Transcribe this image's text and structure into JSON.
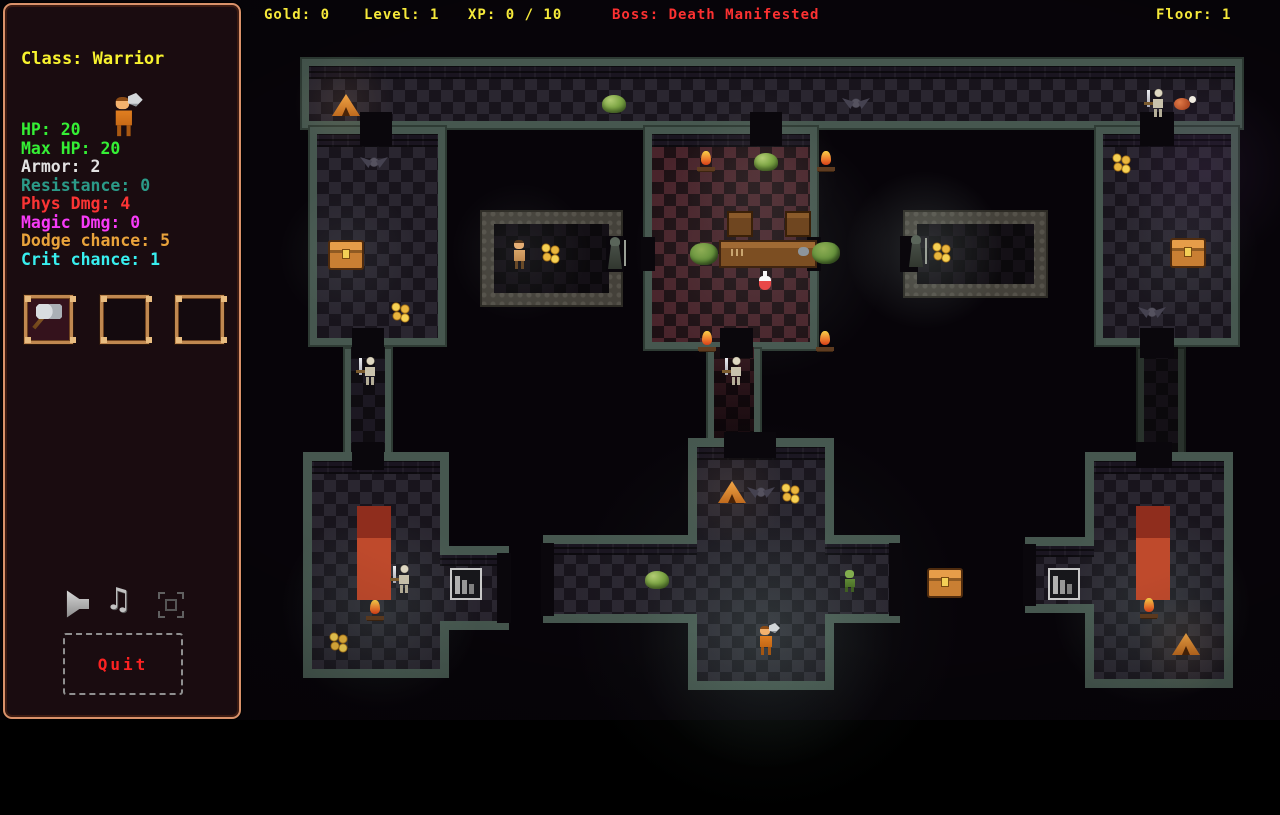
{
  "topbar": {
    "gold": {
      "text": "Gold: 0",
      "color": "#f5e93a"
    },
    "level": {
      "text": "Level: 1",
      "color": "#f5e93a"
    },
    "xp": {
      "text": "XP: 0 / 10",
      "color": "#f5e93a"
    },
    "boss": {
      "text": "Boss: Death Manifested",
      "color": "#fb3131"
    },
    "floor": {
      "text": "Floor: 1",
      "color": "#f5e93a"
    }
  },
  "sidebar": {
    "class_line": {
      "text": "Class: Warrior",
      "color": "#f8f32e"
    },
    "avatar": "warrior-sprite",
    "stats": [
      {
        "text": "HP: 20",
        "color": "#35ef35"
      },
      {
        "text": "Max HP: 20",
        "color": "#35ef35"
      },
      {
        "text": "Armor: 2",
        "color": "#e2e2e2"
      },
      {
        "text": "Resistance: 0",
        "color": "#2b9a88"
      },
      {
        "text": "Phys Dmg: 4",
        "color": "#fb3434"
      },
      {
        "text": "Magic Dmg: 0",
        "color": "#f73bf7"
      },
      {
        "text": "Dodge chance: 5",
        "color": "#e9a33b"
      },
      {
        "text": "Crit chance: 1",
        "color": "#38efef"
      }
    ],
    "inventory_slots": [
      {
        "item": "axe"
      },
      {
        "item": null
      },
      {
        "item": null
      }
    ],
    "icons": [
      {
        "name": "sound-icon"
      },
      {
        "name": "music-icon",
        "glyph": "♫"
      },
      {
        "name": "fullscreen-icon"
      }
    ],
    "quit": {
      "text": "Quit",
      "color": "#fb2222"
    }
  },
  "map": {
    "wall_color": "#46574f",
    "floor_dark": "#18141c",
    "floor_red": "#1e1014",
    "sprites": [
      {
        "type": "tent",
        "x": 332,
        "y": 94
      },
      {
        "type": "slime",
        "x": 602,
        "y": 95
      },
      {
        "type": "bat",
        "x": 842,
        "y": 96
      },
      {
        "type": "skeleton",
        "x": 1146,
        "y": 88
      },
      {
        "type": "meat",
        "x": 1174,
        "y": 96
      },
      {
        "type": "bat",
        "x": 360,
        "y": 155
      },
      {
        "type": "chest",
        "x": 328,
        "y": 240
      },
      {
        "type": "coins",
        "x": 390,
        "y": 302
      },
      {
        "type": "campfire",
        "x": 697,
        "y": 151
      },
      {
        "type": "slime",
        "x": 754,
        "y": 153
      },
      {
        "type": "campfire",
        "x": 817,
        "y": 151
      },
      {
        "type": "bench",
        "x": 727,
        "y": 211
      },
      {
        "type": "bench",
        "x": 785,
        "y": 211
      },
      {
        "type": "bush",
        "x": 690,
        "y": 243
      },
      {
        "type": "table",
        "x": 719,
        "y": 240
      },
      {
        "type": "bush",
        "x": 812,
        "y": 242
      },
      {
        "type": "potion",
        "x": 759,
        "y": 271
      },
      {
        "type": "campfire",
        "x": 698,
        "y": 331
      },
      {
        "type": "campfire",
        "x": 816,
        "y": 331
      },
      {
        "type": "coins",
        "x": 1111,
        "y": 153
      },
      {
        "type": "chest",
        "x": 1170,
        "y": 238
      },
      {
        "type": "bat",
        "x": 1138,
        "y": 305
      },
      {
        "type": "villager",
        "x": 509,
        "y": 240
      },
      {
        "type": "coins",
        "x": 540,
        "y": 243
      },
      {
        "type": "reaper",
        "x": 604,
        "y": 237
      },
      {
        "type": "reaper",
        "x": 905,
        "y": 235
      },
      {
        "type": "coins",
        "x": 931,
        "y": 242
      },
      {
        "type": "skeleton",
        "x": 358,
        "y": 356
      },
      {
        "type": "skeleton",
        "x": 724,
        "y": 356
      },
      {
        "type": "carpet",
        "x": 357,
        "y": 506
      },
      {
        "type": "skeleton",
        "x": 392,
        "y": 564
      },
      {
        "type": "campfire",
        "x": 366,
        "y": 600
      },
      {
        "type": "coins",
        "x": 328,
        "y": 632
      },
      {
        "type": "shelf",
        "x": 450,
        "y": 568
      },
      {
        "type": "tent",
        "x": 718,
        "y": 481
      },
      {
        "type": "bat",
        "x": 747,
        "y": 485
      },
      {
        "type": "coins",
        "x": 780,
        "y": 483
      },
      {
        "type": "slime",
        "x": 645,
        "y": 571
      },
      {
        "type": "goblin",
        "x": 841,
        "y": 570
      },
      {
        "type": "chest",
        "x": 927,
        "y": 568
      },
      {
        "type": "player",
        "x": 755,
        "y": 626
      },
      {
        "type": "shelf",
        "x": 1048,
        "y": 568
      },
      {
        "type": "carpet",
        "x": 1136,
        "y": 506
      },
      {
        "type": "campfire",
        "x": 1140,
        "y": 598
      },
      {
        "type": "tent",
        "x": 1172,
        "y": 633
      }
    ],
    "doors": [
      {
        "x": 360,
        "y": 112,
        "w": 32,
        "h": 34
      },
      {
        "x": 750,
        "y": 112,
        "w": 32,
        "h": 34
      },
      {
        "x": 1140,
        "y": 112,
        "w": 34,
        "h": 34
      },
      {
        "x": 352,
        "y": 328,
        "w": 32,
        "h": 30
      },
      {
        "x": 720,
        "y": 328,
        "w": 33,
        "h": 30
      },
      {
        "x": 1140,
        "y": 328,
        "w": 34,
        "h": 30
      },
      {
        "x": 352,
        "y": 442,
        "w": 32,
        "h": 28
      },
      {
        "x": 724,
        "y": 432,
        "w": 52,
        "h": 26
      },
      {
        "x": 1136,
        "y": 442,
        "w": 36,
        "h": 26
      },
      {
        "x": 641,
        "y": 237,
        "w": 14,
        "h": 34
      },
      {
        "x": 807,
        "y": 237,
        "w": 14,
        "h": 34
      },
      {
        "x": 606,
        "y": 236,
        "w": 18,
        "h": 36
      },
      {
        "x": 900,
        "y": 236,
        "w": 18,
        "h": 36
      },
      {
        "x": 497,
        "y": 553,
        "w": 14,
        "h": 70
      },
      {
        "x": 541,
        "y": 543,
        "w": 13,
        "h": 73
      },
      {
        "x": 889,
        "y": 543,
        "w": 13,
        "h": 73
      },
      {
        "x": 1023,
        "y": 544,
        "w": 13,
        "h": 62
      }
    ],
    "glows": [
      {
        "x": 766,
        "y": 640,
        "r": 130,
        "color": "rgba(160,210,190,0.13)"
      },
      {
        "x": 766,
        "y": 615,
        "r": 200,
        "color": "rgba(140,190,170,0.06)"
      },
      {
        "x": 380,
        "y": 610,
        "r": 100,
        "color": "rgba(150,200,180,0.13)"
      },
      {
        "x": 1152,
        "y": 608,
        "r": 100,
        "color": "rgba(150,200,180,0.14)"
      },
      {
        "x": 762,
        "y": 250,
        "r": 130,
        "color": "rgba(170,200,190,0.10)"
      },
      {
        "x": 760,
        "y": 170,
        "r": 80,
        "color": "rgba(180,170,160,0.08)"
      },
      {
        "x": 925,
        "y": 250,
        "r": 80,
        "color": "rgba(190,220,210,0.16)"
      },
      {
        "x": 520,
        "y": 252,
        "r": 70,
        "color": "rgba(180,200,195,0.08)"
      },
      {
        "x": 1205,
        "y": 170,
        "r": 95,
        "color": "rgba(120,75,150,0.12)"
      },
      {
        "x": 344,
        "y": 103,
        "r": 50,
        "color": "rgba(230,170,110,0.10)"
      },
      {
        "x": 732,
        "y": 492,
        "r": 55,
        "color": "rgba(230,170,110,0.08)"
      },
      {
        "x": 1185,
        "y": 645,
        "r": 50,
        "color": "rgba(230,170,110,0.10)"
      },
      {
        "x": 348,
        "y": 255,
        "r": 70,
        "color": "rgba(170,200,190,0.07)"
      },
      {
        "x": 1185,
        "y": 252,
        "r": 75,
        "color": "rgba(170,200,190,0.07)"
      }
    ]
  }
}
